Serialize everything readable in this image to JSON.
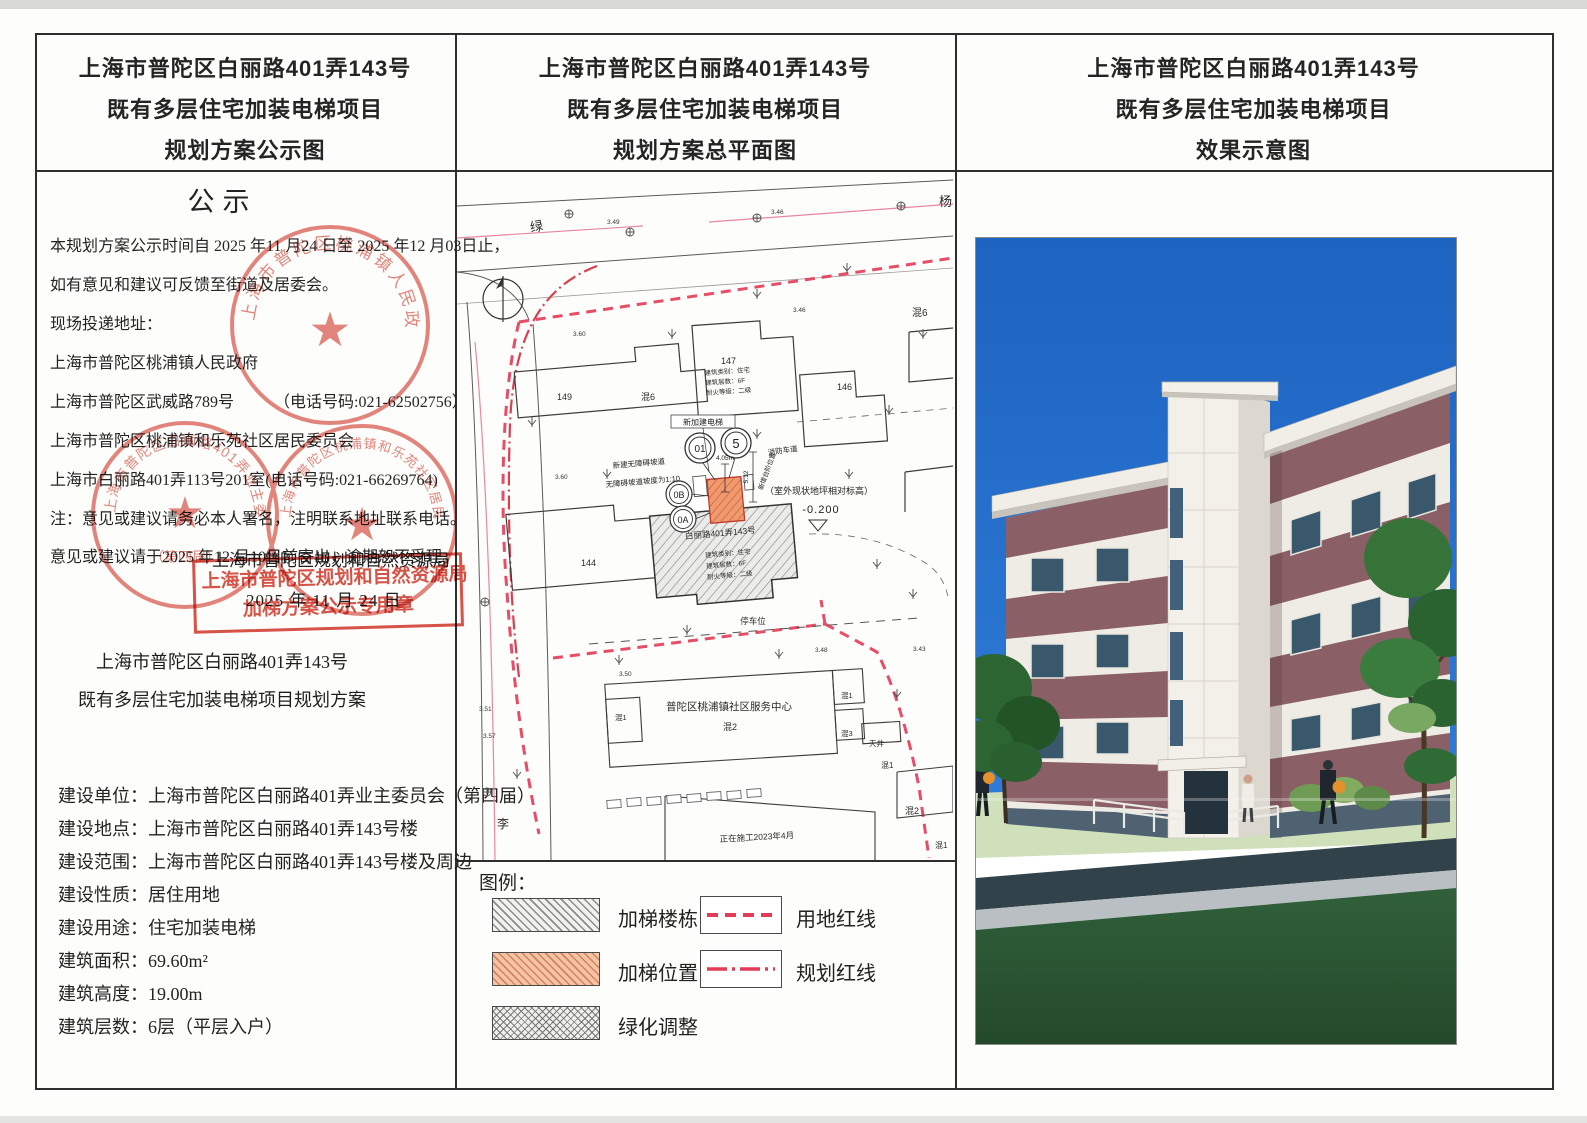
{
  "panels": {
    "left": {
      "header": [
        "上海市普陀区白丽路401弄143号",
        "既有多层住宅加装电梯项目",
        "规划方案公示图"
      ],
      "notice_title": "公示",
      "lines": [
        "本规划方案公示时间自 2025 年11 月24 日至 2025 年12 月03日止，",
        "如有意见和建议可反馈至街道及居委会。",
        "现场投递地址：",
        "上海市普陀区桃浦镇人民政府",
        "上海市普陀区武威路789号　　　（电话号码:021-62502756）",
        "上海市普陀区桃浦镇和乐苑社区居民委员会",
        "上海市白丽路401弄113号201室(电话号码:021-66269764)",
        "注：意见或建议请务必本人署名，注明联系地址联系电话。",
        "意见或建议请于2025 年12 月10日前寄出，逾期恕不受理。"
      ],
      "authority": "上海市普陀区规划和自然资源局",
      "date": "2025 年 11 月 24 日",
      "stamp_box": [
        "上海市普陀区规划和自然资源局",
        "加梯方案公示专用章"
      ],
      "seals": [
        "上海市普陀区桃浦镇人民政府",
        "上海市普陀区白丽路401弄业主委员会",
        "上海市普陀区桃浦镇和乐苑社区居民委员会"
      ],
      "seal2_sub": "（第四届）",
      "seal_star": "★",
      "project_title": [
        "上海市普陀区白丽路401弄143号",
        "既有多层住宅加装电梯项目规划方案"
      ],
      "details": [
        {
          "label": "建设单位：",
          "value": "上海市普陀区白丽路401弄业主委员会（第四届）"
        },
        {
          "label": "建设地点：",
          "value": "上海市普陀区白丽路401弄143号楼"
        },
        {
          "label": "建设范围：",
          "value": "上海市普陀区白丽路401弄143号楼及周边"
        },
        {
          "label": "建设性质：",
          "value": "居住用地"
        },
        {
          "label": "建设用途：",
          "value": "住宅加装电梯"
        },
        {
          "label": "建筑面积：",
          "value": "69.60m²"
        },
        {
          "label": "建筑高度：",
          "value": "19.00m"
        },
        {
          "label": "建筑层数：",
          "value": "6层（平层入户）"
        }
      ]
    },
    "middle": {
      "header": [
        "上海市普陀区白丽路401弄143号",
        "既有多层住宅加装电梯项目",
        "规划方案总平面图"
      ],
      "plan": {
        "road1": "绿",
        "road2": "杨",
        "road3": "李",
        "b149": "149",
        "b147": "147",
        "b146": "146",
        "b144": "144",
        "h6a": "混6",
        "h6b": "混6",
        "h1a": "混1",
        "h1b": "混1",
        "h1c": "混1",
        "h1d": "混1",
        "h2a": "混2",
        "h2b": "混2",
        "h3": "混3",
        "tianjing": "天井",
        "center": "普陀区桃浦镇社区服务中心",
        "parking": "停车位",
        "construction": "正在施工2023年4月",
        "new_lift": "新加建电梯",
        "ramp1": "新建无障碍坡道",
        "ramp2": "无障碍坡道坡度为1:10",
        "fire": "消防车道",
        "steps": "新增台阶位置",
        "dim1": "4.05m",
        "dim2": "5.12",
        "ground_note": "（室外现状地坪相对标高）",
        "ground_val": "-0.200",
        "main_name": "白丽路401弄143号",
        "info1": "建筑类别：住宅",
        "info2": "建筑层数：6F",
        "info3": "耐火等级：二级",
        "c01": "01",
        "c5": "5",
        "c0b": "0B",
        "c0a": "0A",
        "e349": "3.49",
        "e346a": "3.46",
        "e346b": "3.46",
        "e360a": "3.60",
        "e360b": "3.60",
        "e350": "3.50",
        "e351": "3.51",
        "e348": "3.48",
        "e343": "3.43",
        "e357": "3.57"
      },
      "legend": {
        "title": "图例：",
        "items": [
          {
            "label": "加梯楼栋"
          },
          {
            "label": "加梯位置"
          },
          {
            "label": "绿化调整"
          },
          {
            "label": "用地红线"
          },
          {
            "label": "规划红线"
          }
        ]
      }
    },
    "right": {
      "header": [
        "上海市普陀区白丽路401弄143号",
        "既有多层住宅加装电梯项目",
        "效果示意图"
      ]
    }
  },
  "colors": {
    "seal_red": "#d23b2e",
    "boundary_red": "#e23b55",
    "planning_red": "#d84050",
    "lift_salmon": "#ed9263",
    "sky_blue": "#2272cc",
    "lawn_green": "#2d5a34",
    "wall_maroon": "#8a5f66"
  }
}
